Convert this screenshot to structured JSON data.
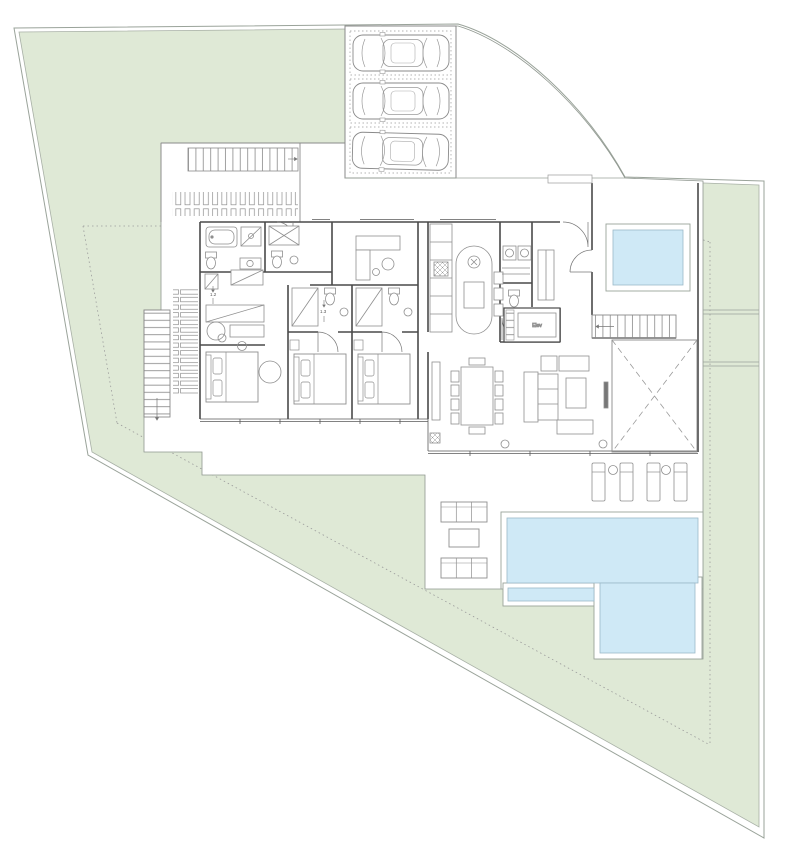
{
  "document": {
    "type": "architectural-floor-plan",
    "description": "Ground floor plan of a villa with wrap-around lawn, curved driveway corner with three parked cars, bedroom wing, living-dining wing, plunge pool courtyard and large L-shaped swimming pool with sun deck"
  },
  "labels": {
    "elevator": "Elev",
    "dim_dressing": "1.2",
    "dim_hall": "1.3"
  },
  "colors": {
    "paper": "#ffffff",
    "lawn": "#dfe9d6",
    "pool_water": "#cfe9f6",
    "pool_edge": "#9bb9c8",
    "boundary": "#9aa39a",
    "walls": "#4a4a4a",
    "furniture": "#8f8f8f",
    "setback_dashed": "#9b9b9b"
  },
  "site": {
    "garden": "wrap-around lawn",
    "boundary_shape": "irregular plot, curved street corner at top right, triangular tip at bottom right",
    "setback_line_style": "dotted inset line parallel to boundaries"
  },
  "inventory": {
    "cars": 3,
    "parking_bays": 3,
    "pools": 2,
    "sun_loungers": 4,
    "poolside_tables": 2,
    "outdoor_sofas": 2,
    "outdoor_coffee_tables": 1,
    "beds": 3,
    "dining_chairs": 10,
    "staircases": 3,
    "columns": 2
  }
}
